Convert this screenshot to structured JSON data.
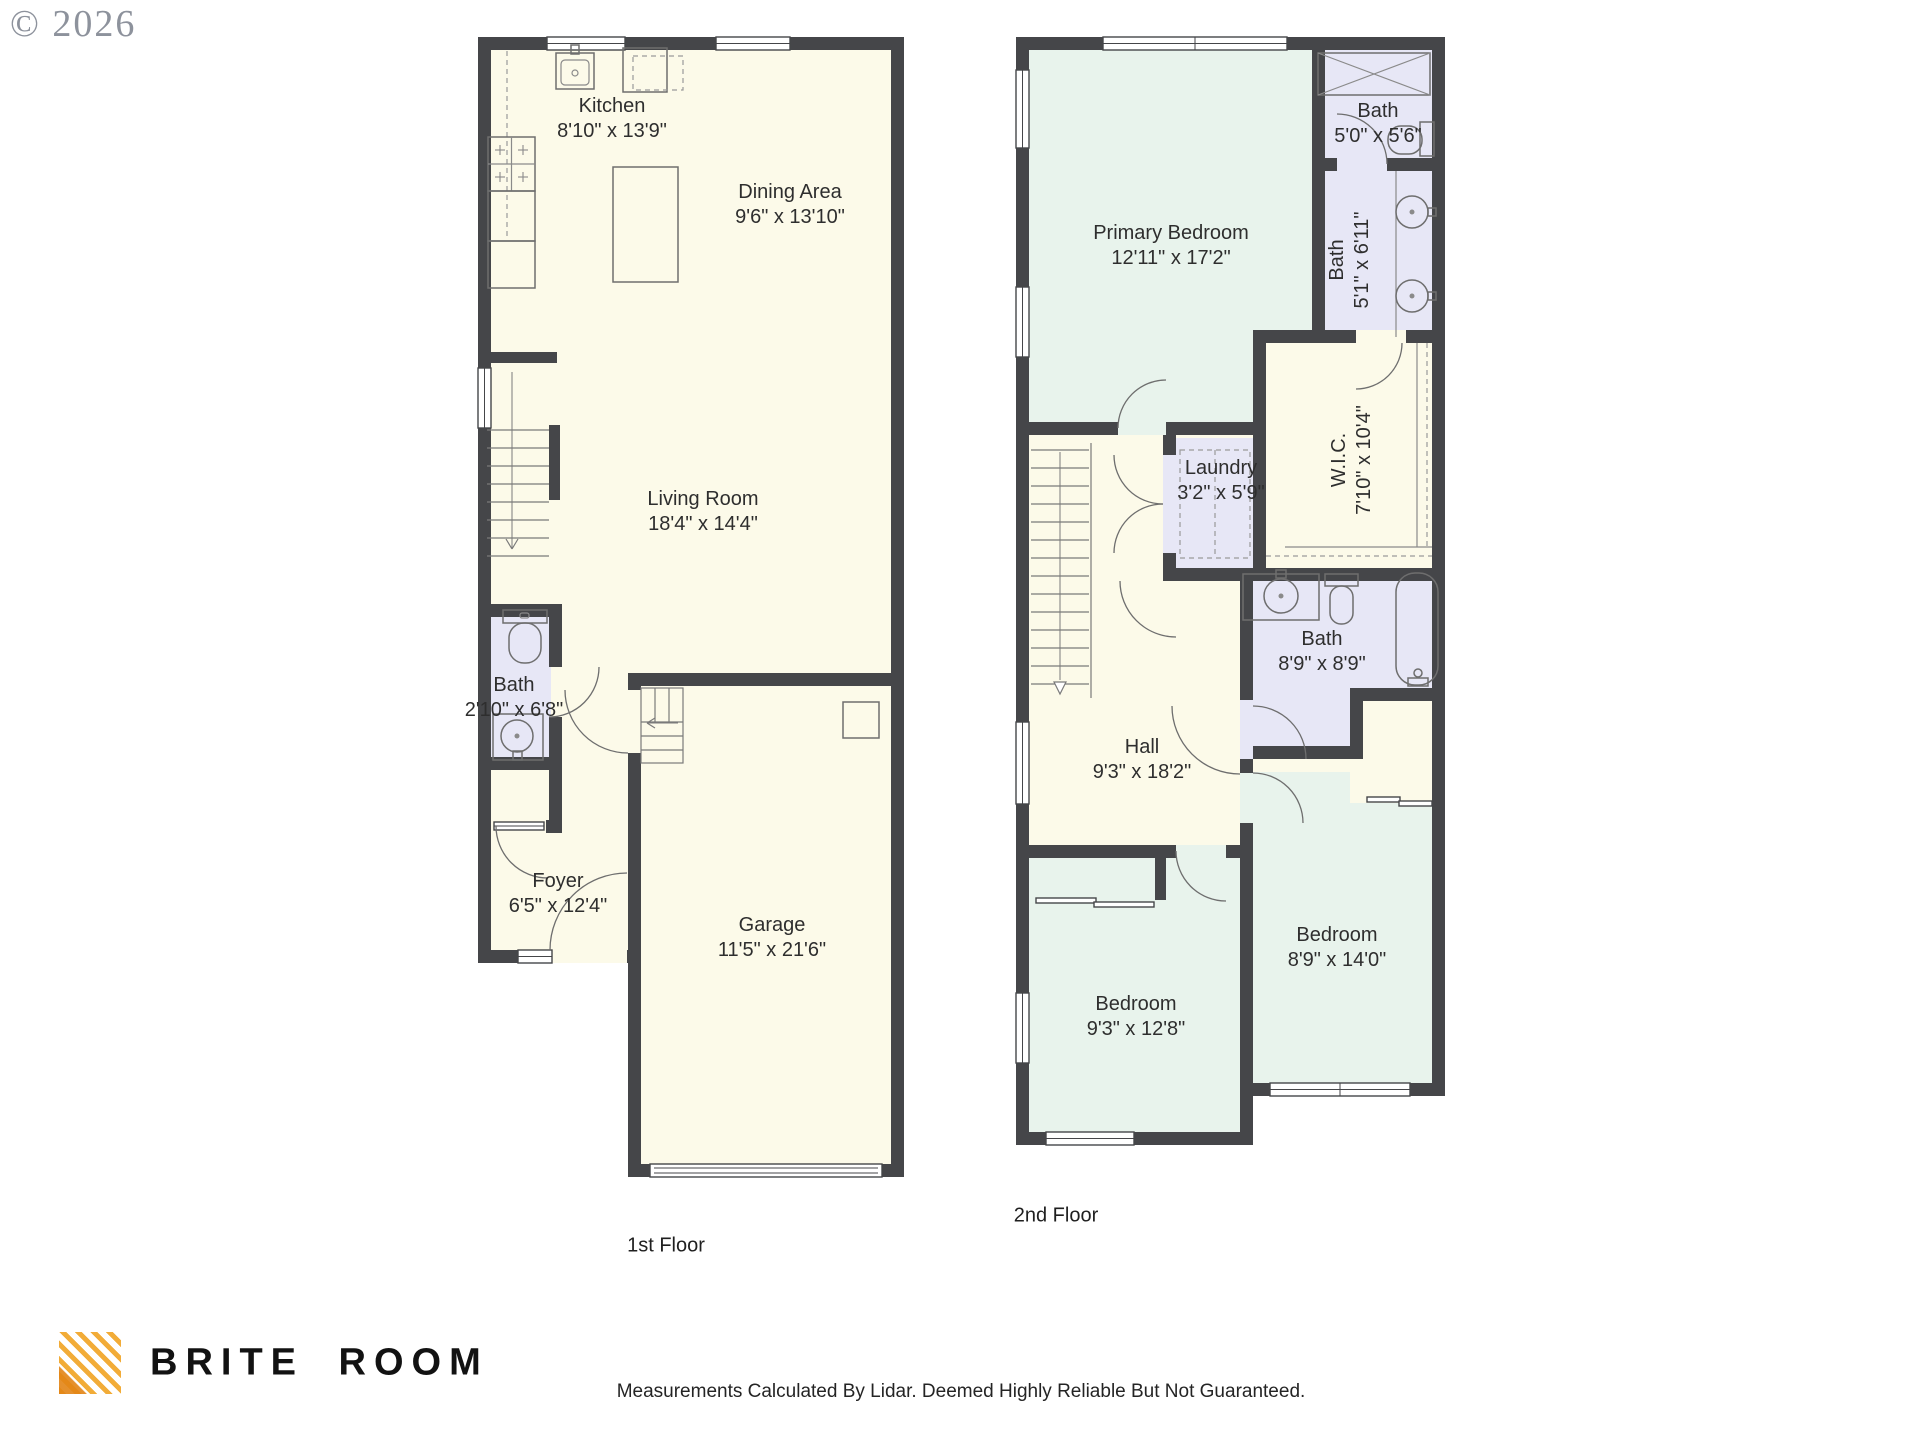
{
  "copyright": "© 2026",
  "floor1": {
    "label": "1st Floor",
    "rooms": [
      {
        "name": "Kitchen",
        "dims": "8'10\" x 13'9\""
      },
      {
        "name": "Dining Area",
        "dims": "9'6\" x 13'10\""
      },
      {
        "name": "Living Room",
        "dims": "18'4\" x 14'4\""
      },
      {
        "name": "Bath",
        "dims": "2'10\" x 6'8\""
      },
      {
        "name": "Foyer",
        "dims": "6'5\" x 12'4\""
      },
      {
        "name": "Garage",
        "dims": "11'5\" x 21'6\""
      }
    ]
  },
  "floor2": {
    "label": "2nd Floor",
    "rooms": [
      {
        "name": "Primary Bedroom",
        "dims": "12'11\" x 17'2\""
      },
      {
        "name": "Bath",
        "dims": "5'0\" x 5'6\""
      },
      {
        "name": "Bath",
        "dims": "5'1\" x 6'11\""
      },
      {
        "name": "Laundry",
        "dims": "3'2\" x 5'9\""
      },
      {
        "name": "W.I.C.",
        "dims": "7'10\" x 10'4\""
      },
      {
        "name": "Bath",
        "dims": "8'9\" x 8'9\""
      },
      {
        "name": "Hall",
        "dims": "9'3\" x 18'2\""
      },
      {
        "name": "Bedroom",
        "dims": "9'3\" x 12'8\""
      },
      {
        "name": "Bedroom",
        "dims": "8'9\" x 14'0\""
      }
    ]
  },
  "branding": {
    "company": "BRITE ROOM"
  },
  "footer": {
    "disclaimer": "Measurements Calculated By Lidar. Deemed Highly Reliable But Not Guaranteed."
  },
  "colors": {
    "wall": "#454649",
    "room_cream": "#fcfae9",
    "room_mint": "#e8f3ec",
    "room_lavender": "#e7e7f6",
    "logo_gold": "#f2ac38",
    "copyright_gray": "#8d929c"
  }
}
